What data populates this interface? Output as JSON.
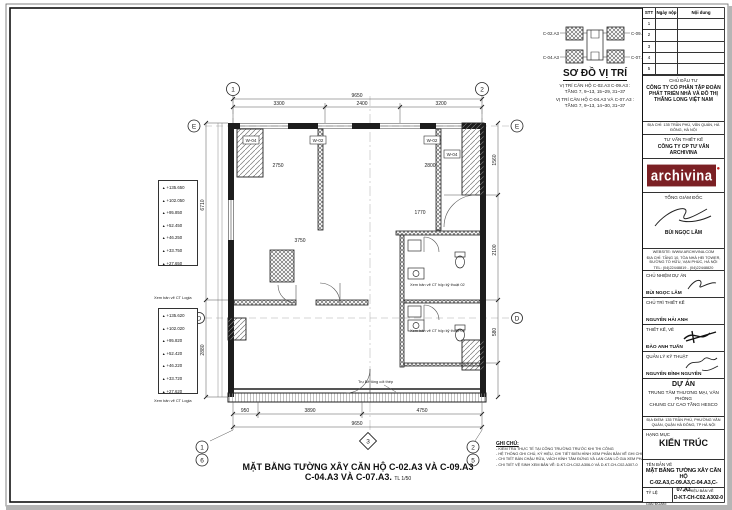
{
  "key_plan": {
    "title": "SƠ ĐỒ VỊ TRÍ",
    "unit_labels": [
      "C-02.A3",
      "C-09.A3",
      "C-04.A3",
      "C-07.A3"
    ],
    "notes": [
      "VỊ TRÍ CĂN HỘ C-02.A3 C-09.A3 :",
      "TẦNG 7, 9~13, 15~29, 31~37",
      "VỊ TRÍ CĂN HỘ C-04.A3 VÀ C-07.A3 :",
      "TẦNG 7, 9~13, 14~30, 31~37"
    ]
  },
  "revision_table": {
    "headers": [
      "STT",
      "Ngày nộp",
      "Nội dung"
    ],
    "rows": [
      "1",
      "2",
      "3",
      "4",
      "5"
    ]
  },
  "owner": {
    "label": "CHỦ ĐẦU TƯ",
    "name": "CÔNG TY CỔ PHẦN TẬP ĐOÀN PHÁT TRIỂN NHÀ VÀ ĐÔ THỊ THĂNG LONG VIỆT NAM",
    "address": "ĐỊA CHỈ: 135 TRẦN PHÚ, VĂN QUÁN, HÀ ĐÔNG, HÀ NỘI"
  },
  "consultant": {
    "label": "TƯ VẤN THIẾT KẾ",
    "name": "CÔNG TY CP TƯ VẤN ARCHIVINA",
    "logo_text": "archivina",
    "director_label": "TỔNG GIÁM ĐỐC",
    "director_name": "BÙI NGỌC LÂM",
    "contact_line1": "WEBSITE: WWW.ARCHIVINA.COM",
    "contact_line2": "ĐỊA CHỈ: TẦNG 10, TÒA NHÀ HEI TOWER, ĐƯỜNG TỐ HỮU, VẠN PHÚC, HÀ NỘI",
    "contact_line3": "TEL: (04)22448819 - (04)22448820"
  },
  "roles": [
    {
      "label": "CHỦ NHIỆM DỰ ÁN",
      "name": "BÙI NGỌC LÂM"
    },
    {
      "label": "CHỦ TRÌ THIẾT KẾ",
      "name": "NGUYỄN HẢI ANH"
    },
    {
      "label": "THIẾT KẾ, VẼ",
      "name": "ĐÀO ANH TUẤN"
    },
    {
      "label": "QUẢN LÝ KỸ THUẬT",
      "name": "NGUYỄN ĐÌNH NGUYÊN"
    }
  ],
  "project": {
    "label": "DỰ ÁN",
    "name_line1": "TRUNG TÂM THƯƠNG MẠI, VĂN PHÒNG",
    "name_line2": "CHUNG CƯ CAO TẦNG HESCO",
    "location": "ĐỊA ĐIỂM: 135 TRẦN PHÚ, PHƯỜNG VĂN QUÁN, QUẬN HÀ ĐÔNG, TP HÀ NỘI"
  },
  "category": {
    "label": "HẠNG MỤC",
    "value": "KIẾN TRÚC"
  },
  "titleblock": {
    "drawing_label": "TÊN BẢN VẼ",
    "title_line1": "MẶT BẰNG TƯỜNG XÂY CĂN HỘ",
    "title_line2": "C-02.A3,C-09.A3,C-04.A3,C-07.A3",
    "scale_label": "TỶ LỆ",
    "stage_label": "GIAI ĐOẠN:",
    "stage_value": "TKBVTC",
    "code_label": "KÝ HIỆU BẢN VẼ",
    "code_value": "D-KT-CH-C02.A302-0"
  },
  "main_title": {
    "line1": "MẶT BẰNG TƯỜNG XÂY CĂN HỘ C-02.A3 VÀ C-09.A3",
    "line2": "C-04.A3 VÀ C-07.A3.",
    "scale": "TL 1/50"
  },
  "notes": {
    "heading": "GHI CHÚ:",
    "items": [
      "- KIỂM TRA THỰC TẾ TẠI CÔNG TRƯỜNG TRƯỚC KHI THI CÔNG",
      "- HỆ THỐNG GHI CHÚ, KÝ HIỆU, CHI TIẾT ĐIỂN HÌNH XEM PHẦN BẢN VẼ GHI CHÚ CHUNG",
      "- CHI TIẾT BÀN CHẬU RỬA, VÁCH KÍNH TẮM ĐỨNG VÀ LAN CAN LÔ GIA XEM PHẦN BẢN VẼ GHI CHÚ CHUNG",
      "- CHI TIẾT VỆ SINH XEM BẢN VẼ: D-KT-CH-C02.A306-0 VÀ D-KT-CH-C02.A307-0"
    ]
  },
  "plan": {
    "grid": {
      "top": [
        "1",
        "2"
      ],
      "bottom_left": [
        "1",
        "6"
      ],
      "bottom_right": [
        "2",
        "5"
      ],
      "bottom_mid": "3",
      "left": [
        "E",
        "D"
      ],
      "right": [
        "E",
        "D"
      ]
    },
    "dims": {
      "top_total": "9650",
      "top_segs": [
        "3300",
        "2400",
        "3200"
      ],
      "bottom_segs": [
        "950",
        "3890",
        "4750"
      ],
      "bottom_total": "9650",
      "left": [
        "6710",
        "2880"
      ],
      "right": [
        "1560",
        "2100",
        "580"
      ],
      "interior": [
        "2750",
        "2800",
        "3750",
        "1770"
      ]
    },
    "window_tags": [
      "W-04",
      "W-02",
      "W-02",
      "W-04"
    ],
    "elev1": [
      "+135.650",
      "+102.050",
      "+95.850",
      "+52.450",
      "+46.250",
      "+33.750",
      "+27.650"
    ],
    "elev2": [
      "+135.620",
      "+102.020",
      "+95.820",
      "+52.420",
      "+46.220",
      "+33.720",
      "+27.620"
    ],
    "elev_caption": "Xem bản vẽ CT Logia",
    "ann": {
      "tech1": "Xem bản vẽ CT hộp kỹ thuật 02",
      "tech2": "Xem bản vẽ CT hộp kỹ thuật 03",
      "column": "Trụ Bê tông cốt thép"
    }
  }
}
